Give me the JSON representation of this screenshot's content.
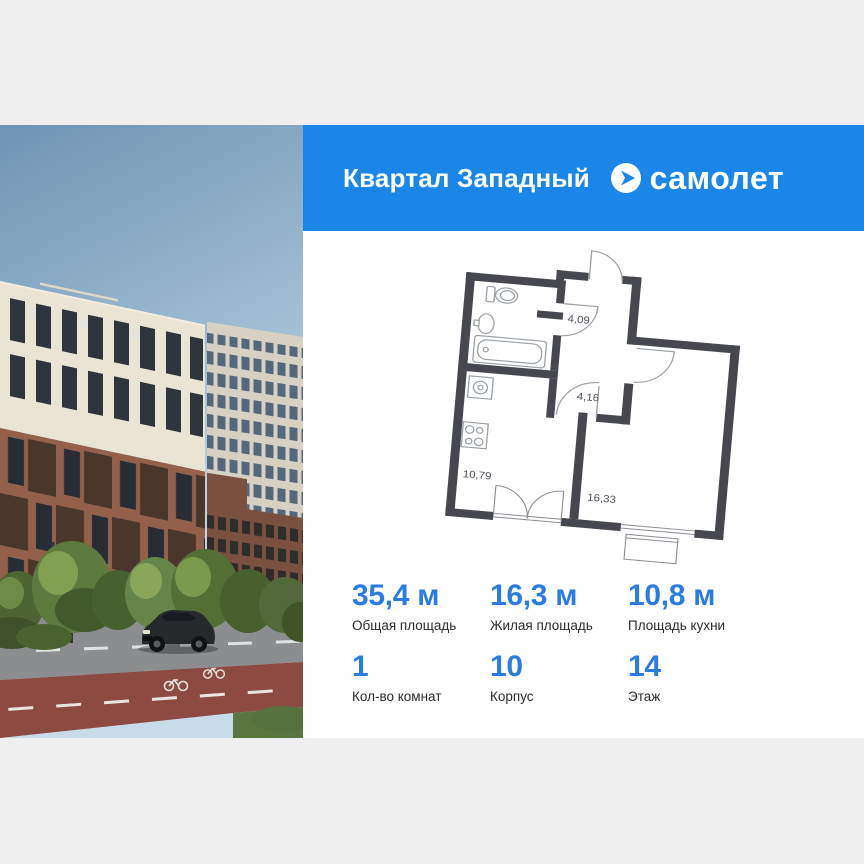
{
  "colors": {
    "page_bg": "#efefef",
    "header_blue": "#1a86e8",
    "accent_blue": "#2b7ce2",
    "plan_wall": "#47484f"
  },
  "header": {
    "title": "Квартал Западный",
    "brand": "самолет"
  },
  "floor_plan": {
    "areas": [
      {
        "name": "hallway",
        "area": "4,09"
      },
      {
        "name": "corridor",
        "area": "4,16"
      },
      {
        "name": "kitchen",
        "area": "10,79"
      },
      {
        "name": "living-room",
        "area": "16,33"
      }
    ]
  },
  "stats": {
    "rows": [
      [
        {
          "value": "35,4 м",
          "label": "Общая площадь"
        },
        {
          "value": "16,3 м",
          "label": "Жилая площадь"
        },
        {
          "value": "10,8 м",
          "label": "Площадь кухни"
        }
      ],
      [
        {
          "value": "1",
          "label": "Кол-во комнат"
        },
        {
          "value": "10",
          "label": "Корпус"
        },
        {
          "value": "14",
          "label": "Этаж"
        }
      ]
    ]
  }
}
